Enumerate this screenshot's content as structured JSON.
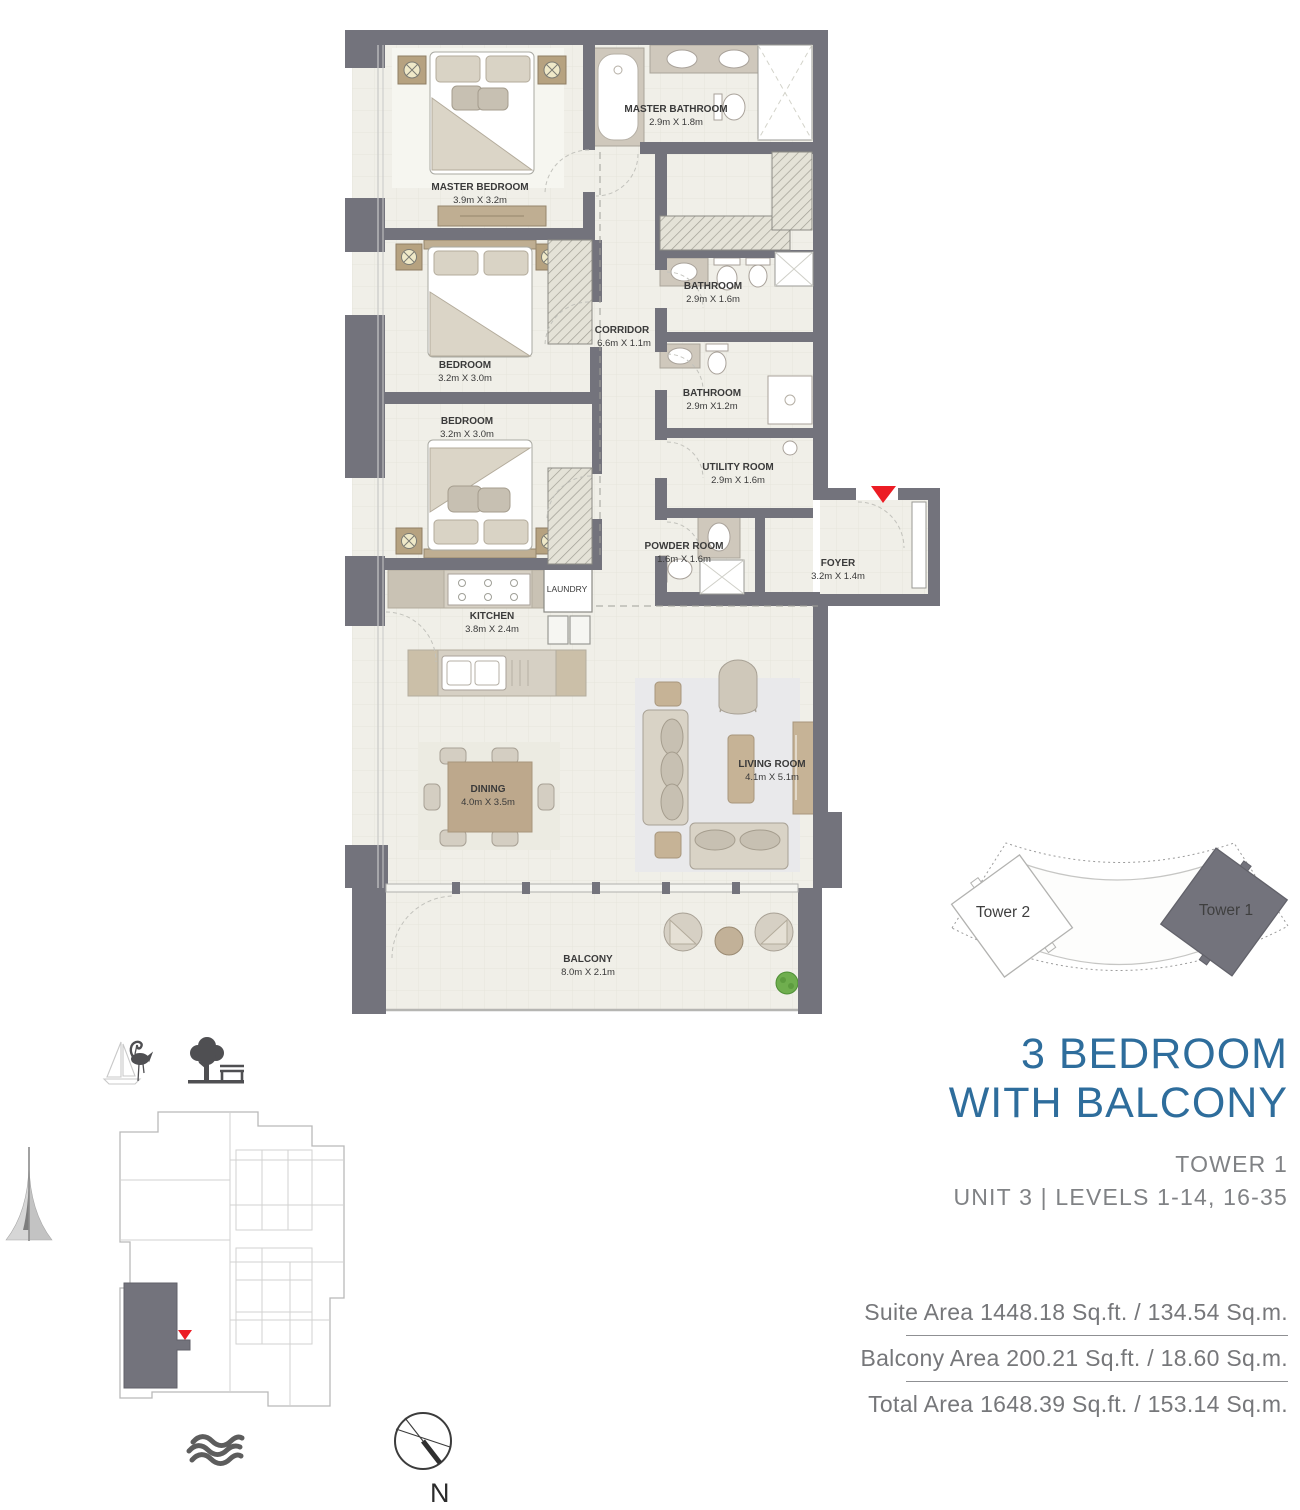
{
  "colors": {
    "accent_blue": "#2E6D9C",
    "wall_gray": "#73737C",
    "floor_cream": "#F0EFE8",
    "red_marker": "#EC1C24",
    "text_gray": "#76777A"
  },
  "floorplan": {
    "rooms": [
      {
        "name": "MASTER BEDROOM",
        "dims": "3.9m X 3.2m"
      },
      {
        "name": "MASTER BATHROOM",
        "dims": "2.9m X 1.8m"
      },
      {
        "name": "BEDROOM",
        "dims": "3.2m X 3.0m"
      },
      {
        "name": "BEDROOM",
        "dims": "3.2m X 3.0m"
      },
      {
        "name": "CORRIDOR",
        "dims": "6.6m X 1.1m"
      },
      {
        "name": "BATHROOM",
        "dims": "2.9m X 1.6m"
      },
      {
        "name": "BATHROOM",
        "dims": "2.9m X1.2m"
      },
      {
        "name": "UTILITY ROOM",
        "dims": "2.9m X 1.6m"
      },
      {
        "name": "POWDER ROOM",
        "dims": "1.6m X 1.6m"
      },
      {
        "name": "LAUNDRY",
        "dims": ""
      },
      {
        "name": "FOYER",
        "dims": "3.2m X 1.4m"
      },
      {
        "name": "KITCHEN",
        "dims": "3.8m X 2.4m"
      },
      {
        "name": "DINING",
        "dims": "4.0m X 3.5m"
      },
      {
        "name": "LIVING ROOM",
        "dims": "4.1m X 5.1m"
      },
      {
        "name": "BALCONY",
        "dims": "8.0m X 2.1m"
      }
    ]
  },
  "site_plan": {
    "tower1_label": "Tower 1",
    "tower2_label": "Tower 2"
  },
  "title": {
    "line1": "3 BEDROOM",
    "line2": "WITH BALCONY"
  },
  "unit_info": {
    "tower": "TOWER 1",
    "unit_levels": "UNIT 3 | LEVELS 1-14, 16-35"
  },
  "areas": {
    "suite": "Suite Area 1448.18 Sq.ft. / 134.54 Sq.m.",
    "balcony": "Balcony Area 200.21 Sq.ft. / 18.60 Sq.m.",
    "total": "Total Area 1648.39 Sq.ft. / 153.14 Sq.m."
  },
  "compass": {
    "label": "N"
  },
  "icons": {
    "flamingo": "flamingo-sailboat-icon",
    "park": "tree-bench-icon",
    "spire": "tower-spire-icon",
    "waves": "waves-icon",
    "compass": "compass-icon"
  }
}
